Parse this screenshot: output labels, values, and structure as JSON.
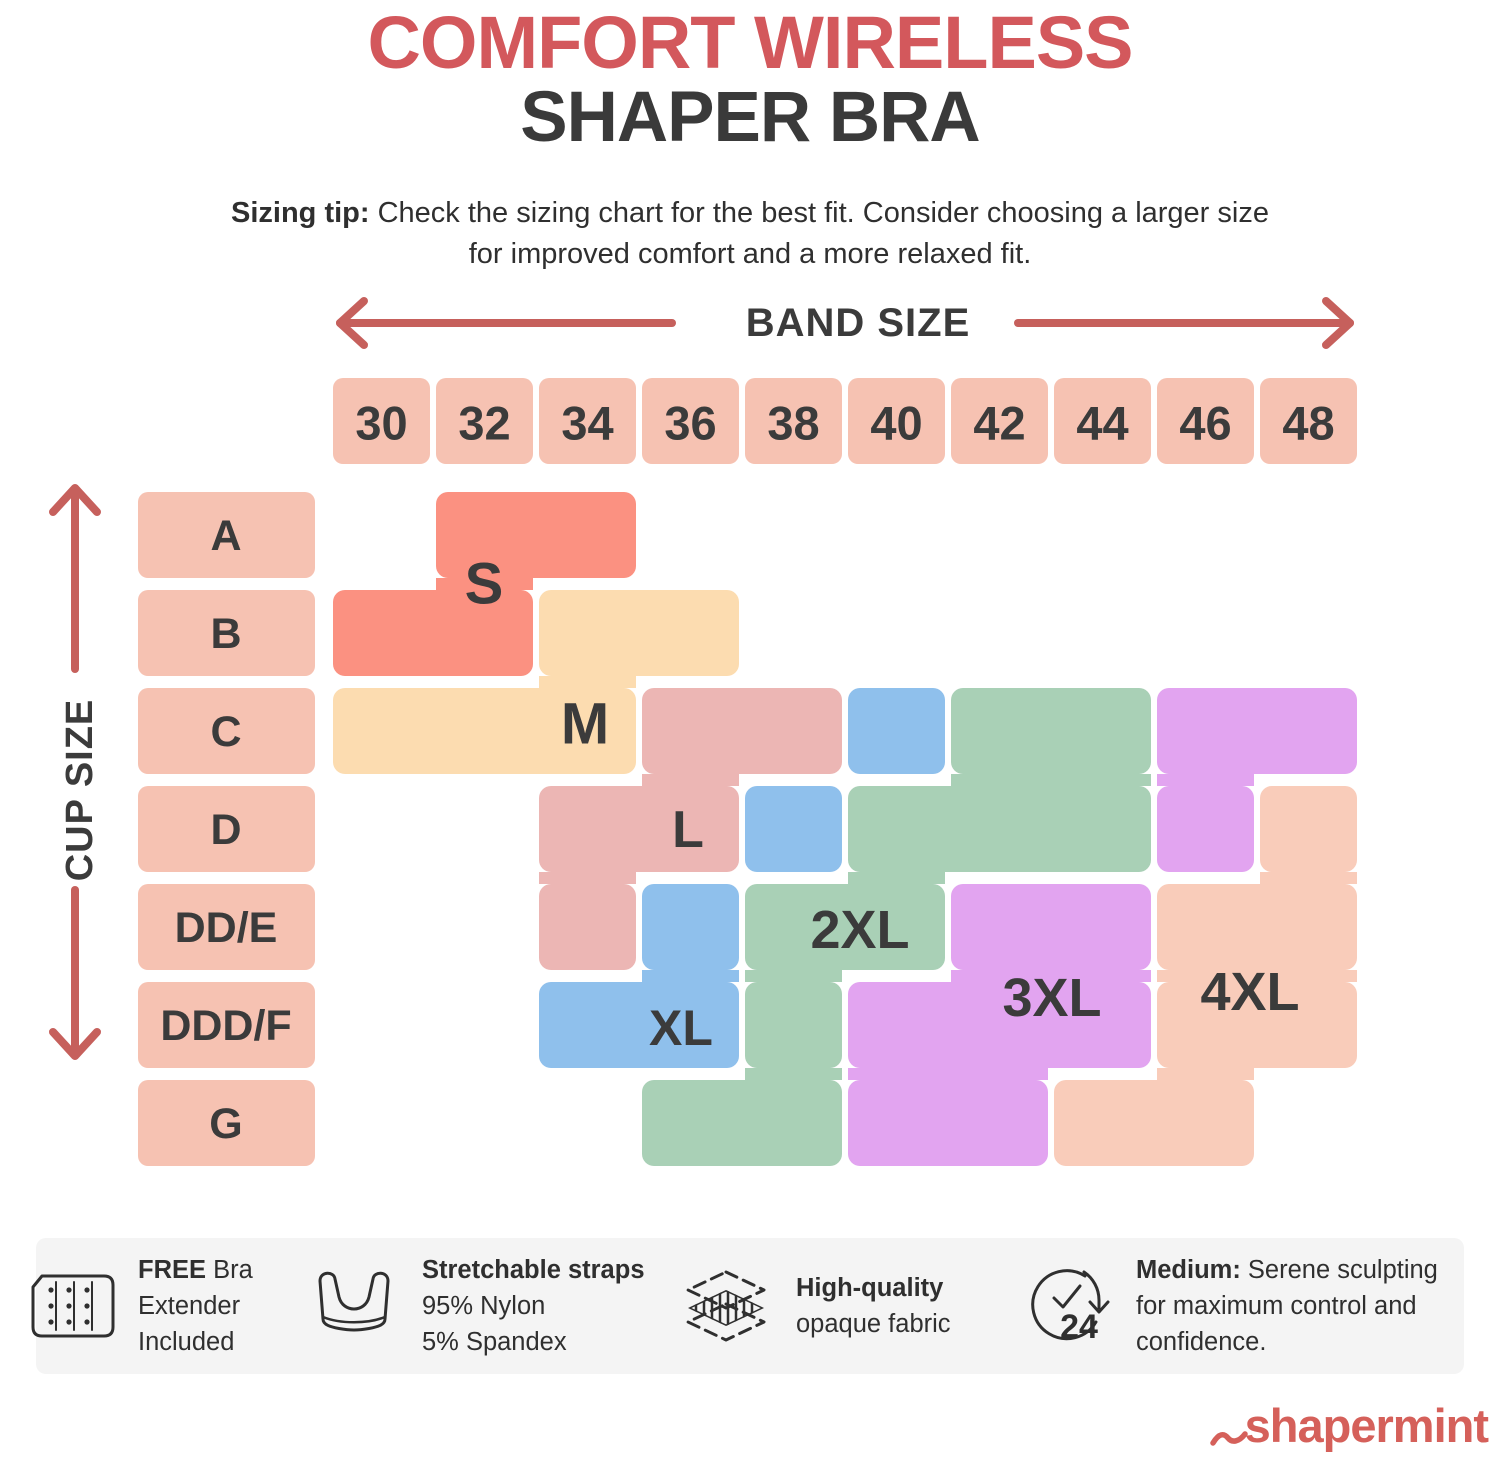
{
  "title": {
    "line1": "COMFORT WIRELESS",
    "line2": "SHAPER BRA"
  },
  "sizing_tip": {
    "label": "Sizing tip:",
    "line1_rest": " Check the sizing chart for the best fit. Consider choosing a larger size",
    "line2": "for improved comfort and a more relaxed fit."
  },
  "chart_data": {
    "type": "heatmap",
    "title": "Comfort Wireless Shaper Bra size chart",
    "x": {
      "label": "BAND SIZE",
      "categories": [
        30,
        32,
        34,
        36,
        38,
        40,
        42,
        44,
        46,
        48
      ]
    },
    "y": {
      "label": "CUP SIZE",
      "categories": [
        "A",
        "B",
        "C",
        "D",
        "DD/E",
        "DDD/F",
        "G"
      ]
    },
    "legend_position": "none",
    "grid": "off",
    "axis_cell_color": "#F6C2B2",
    "sizes": [
      {
        "name": "S",
        "color": "#FB9181",
        "cells": {
          "A": [
            32,
            34
          ],
          "B": [
            30,
            32
          ]
        }
      },
      {
        "name": "M",
        "color": "#FCDCB0",
        "cells": {
          "B": [
            34,
            36
          ],
          "C": [
            30,
            34
          ]
        }
      },
      {
        "name": "L",
        "color": "#ECB6B4",
        "cells": {
          "C": [
            36,
            38
          ],
          "D": [
            34,
            36
          ],
          "DD/E": [
            34,
            34
          ]
        }
      },
      {
        "name": "XL",
        "color": "#8FC0EC",
        "cells": {
          "C": [
            40,
            40
          ],
          "D": [
            38,
            38
          ],
          "DD/E": [
            36,
            36
          ],
          "DDD/F": [
            34,
            36
          ]
        }
      },
      {
        "name": "2XL",
        "color": "#A9D0B6",
        "cells": {
          "C": [
            42,
            44
          ],
          "D": [
            40,
            44
          ],
          "DD/E": [
            38,
            40
          ],
          "DDD/F": [
            38,
            38
          ],
          "G": [
            36,
            38
          ]
        }
      },
      {
        "name": "3XL",
        "color": "#E2A4F0",
        "cells": {
          "C": [
            46,
            48
          ],
          "D": [
            46,
            46
          ],
          "DD/E": [
            42,
            44
          ],
          "DDD/F": [
            40,
            44
          ],
          "G": [
            40,
            42
          ]
        }
      },
      {
        "name": "4XL",
        "color": "#F9CCBA",
        "cells": {
          "D": [
            48,
            48
          ],
          "DD/E": [
            46,
            48
          ],
          "DDD/F": [
            46,
            48
          ],
          "G": [
            44,
            46
          ]
        }
      }
    ]
  },
  "features": [
    {
      "icon": "bra-extender-icon",
      "lines": [
        {
          "b": "FREE",
          "t": " Bra"
        },
        {
          "b": "",
          "t": "Extender"
        },
        {
          "b": "",
          "t": "Included"
        }
      ]
    },
    {
      "icon": "bra-icon",
      "lines": [
        {
          "b": "Stretchable straps",
          "t": ""
        },
        {
          "b": "",
          "t": "95% Nylon"
        },
        {
          "b": "",
          "t": "5% Spandex"
        }
      ]
    },
    {
      "icon": "fabric-layers-icon",
      "lines": [
        {
          "b": "High-quality",
          "t": ""
        },
        {
          "b": "",
          "t": "opaque fabric"
        }
      ]
    },
    {
      "icon": "clock-24-icon",
      "clock_number": "24",
      "lines": [
        {
          "b": "Medium:",
          "t": " Serene sculpting"
        },
        {
          "b": "",
          "t": "for maximum control and"
        },
        {
          "b": "",
          "t": "confidence."
        }
      ]
    }
  ],
  "logo": {
    "text": "shapermint"
  },
  "colors": {
    "title_red": "#D3585C",
    "arrow_red": "#C6605C",
    "text_dark": "#3B3B3B",
    "body_text": "#2F2F2F",
    "axis_cell_pink": "#F6C2B2",
    "strip_gray": "#F4F4F4",
    "logo_red": "#D5605A"
  }
}
